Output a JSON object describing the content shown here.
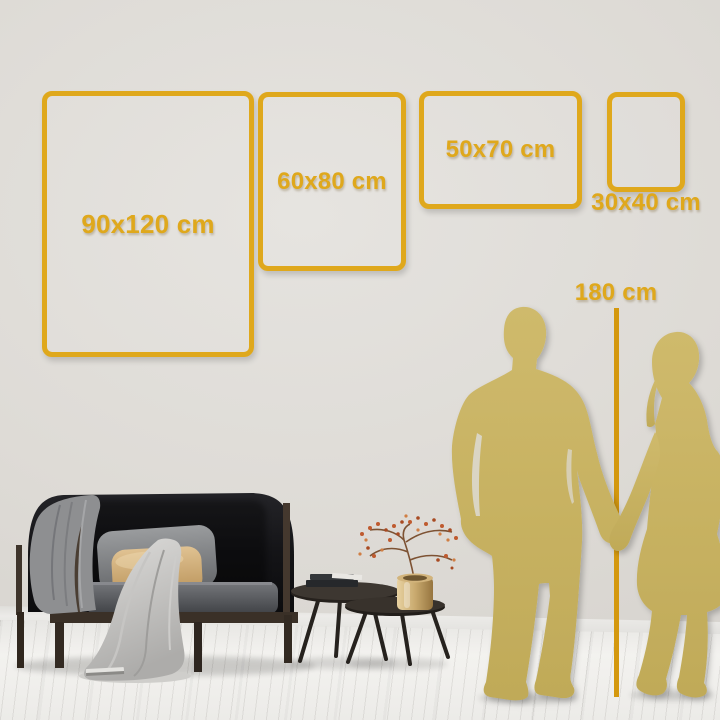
{
  "colors": {
    "accent": "#DFA81C",
    "ruler": "#D4980E",
    "silhouette": "#C9B364",
    "wall": "#DCD9D4",
    "floor": "#F1F0ED"
  },
  "size_guide": {
    "frames": [
      {
        "label": "90x120 cm",
        "width_cm": 90,
        "height_cm": 120,
        "orientation": "portrait"
      },
      {
        "label": "60x80 cm",
        "width_cm": 60,
        "height_cm": 80,
        "orientation": "portrait"
      },
      {
        "label": "50x70 cm",
        "width_cm": 50,
        "height_cm": 70,
        "orientation": "landscape"
      },
      {
        "label": "30x40 cm",
        "width_cm": 30,
        "height_cm": 40,
        "orientation": "portrait"
      }
    ],
    "reference": {
      "label": "180 cm",
      "height_cm": 180
    }
  }
}
